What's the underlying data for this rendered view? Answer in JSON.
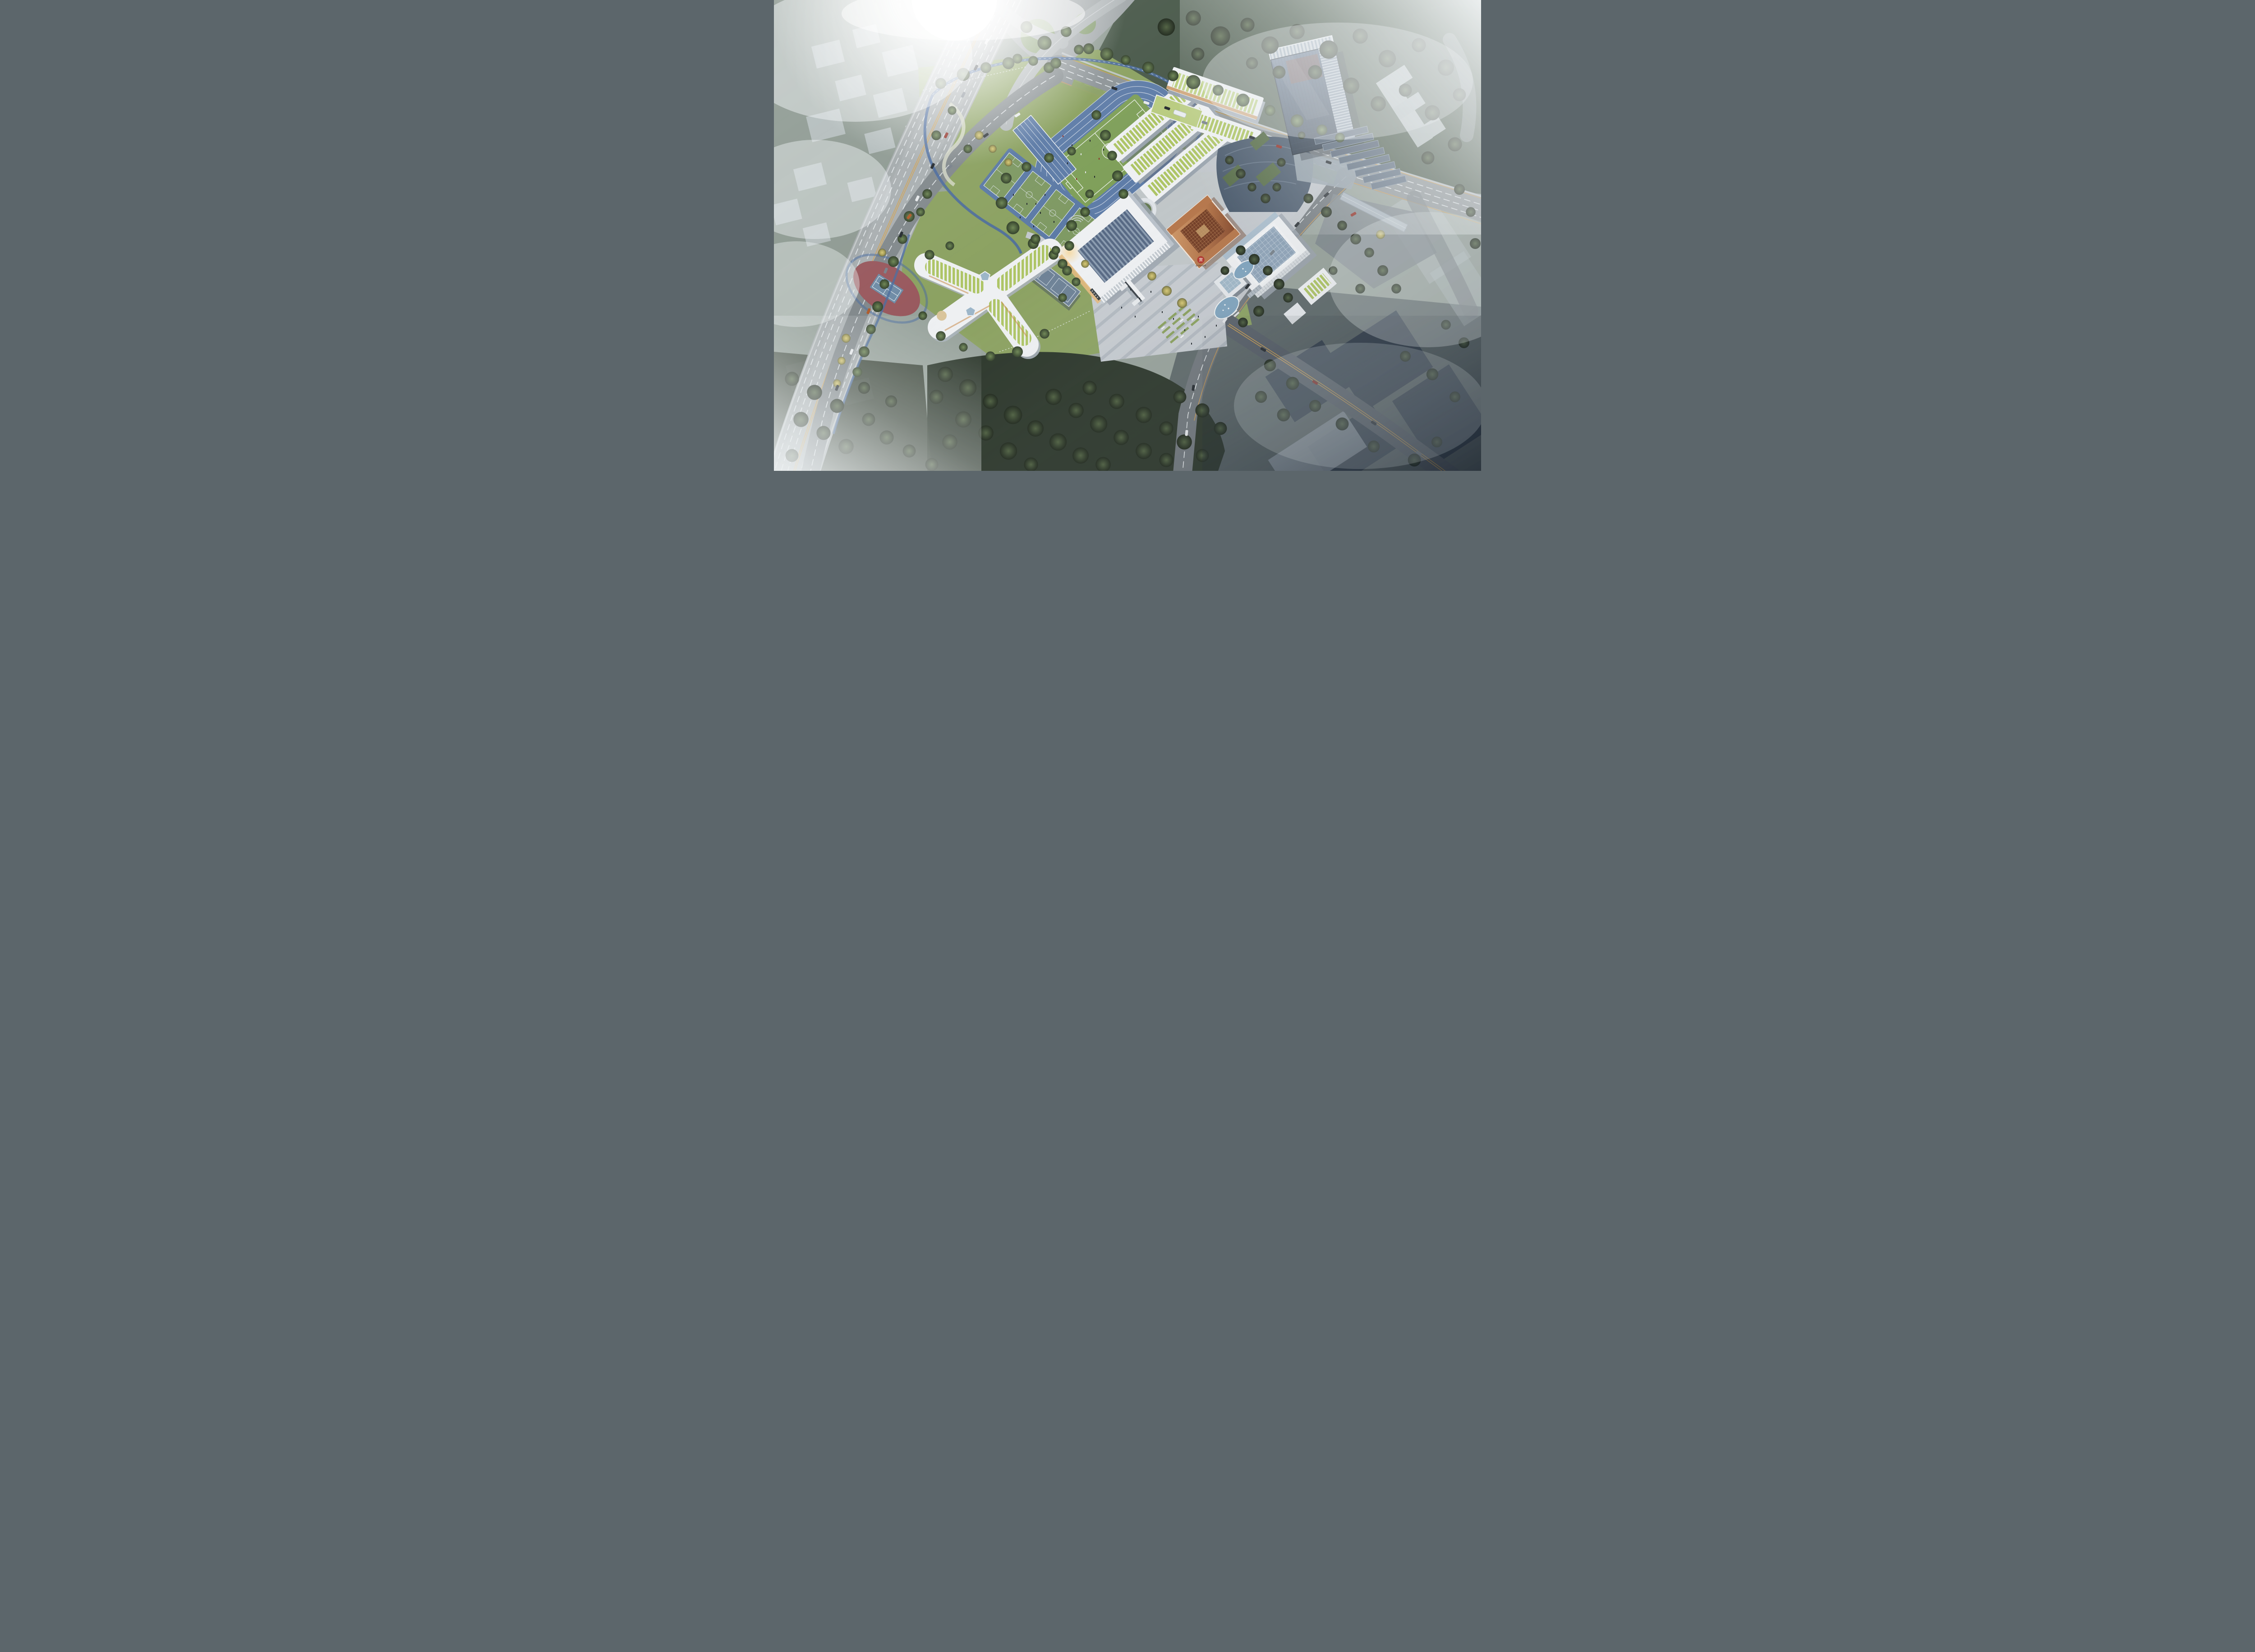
{
  "image": {
    "kind": "photorealistic aerial architectural rendering",
    "subject": "school campus masterplan at a foggy urban highway interchange",
    "lighting": "hazy morning sun flare from upper-left, dark mist toward lower-right"
  },
  "branding": {
    "seal_character": "實",
    "seal_text": "温州市实验中学",
    "seal_color": "#b0342c"
  },
  "zones": {
    "sports": {
      "running_track": "blue 6-lane oval running track with green soccer field",
      "long_jump": "blue sprint/long-jump strip beside track",
      "basketball": "row of 4 green basketball courts on blue pad",
      "badminton": "covered badminton canopy south of courts",
      "tennis": "single blue tennis court on red oval pad in linear park"
    },
    "buildings": {
      "classroom_wings": "three parallel white teaching slabs with green roof strips",
      "north_building": "white classroom bar with green louvered roof along north road",
      "auditorium": "white hall with sawtooth blue-grey skylight roof and colonnade",
      "library_cube": "copper-clad cube with carved lattice roof and red school seal",
      "gymnasium": "white box with large blue-grey glazed roof panel",
      "kindergarten": "white X-shaped building with green striped roofs and two pentagonal skylights",
      "tower": "dark glass high-rise with louvered core and stepped garden terraces",
      "entrance_gate": "white portal gate with dark sign band on south plaza",
      "pavilion": "small glass-roofed pavilion beside fountain ponds"
    },
    "landscape": {
      "sunken_courtyard": "circular glowing sunken courtyard",
      "plaza": "striped paving plaza with lawn modules, benches and ginkgo trees",
      "ponds": "two kidney-shaped fountain pools",
      "forest_south": "dense dark tree parcel south of campus",
      "linear_park": "jogging-loop park strip along elevated highway",
      "fog": "translucent white massing blocks of surrounding city fading into mist"
    },
    "roads": {
      "highway": "elevated multi-lane highway running diagonally on the left",
      "interchange": "curved ramp interchange at top-left under sun flare",
      "north_arterial": "walled arterial road across the top with bus and crosswalk",
      "east_road": "tree-lined road along east campus edge with crosswalks",
      "southeast_road": "dark road with double yellow line fading into fog",
      "sky_bridge": "pedestrian bridge from tower terraces across intersection"
    }
  },
  "counts": {
    "track_lanes": 6,
    "basketball_courts": 4,
    "soccer_goals": 2,
    "classroom_wings": 3,
    "pentagon_skylights": 2,
    "fountain_pools": 2
  },
  "colors": {
    "track_blue": "#5f7da8",
    "field_green": "#7fa05a",
    "court_green": "#7f9a64",
    "court_pad_blue": "#5d7ba6",
    "tennis_red": "#99595e",
    "tennis_blue": "#6f8ca6",
    "jog_path_blue": "#4c6d9e",
    "lawn": "#8ca262",
    "forest_dark": "#2c372b",
    "tree_yellow": "#c7ba66",
    "asphalt_light": "#a4aaac",
    "asphalt_mid": "#8e9598",
    "asphalt_dark": "#5a626b",
    "lane_yellow": "#d2a455",
    "building_white": "#eef0f2",
    "roof_green": "#aec566",
    "sawtooth_blue": "#5d7089",
    "copper_light": "#cf9a6a",
    "copper_dark": "#7d4228",
    "lattice_brown": "#713c24",
    "glass_blue": "#8ea3b7",
    "tower_glass": "#3e4f63",
    "podium_slate": "#4a5a6c",
    "pond_blue": "#7fa3bd",
    "plaza_grey": "#c6cbd0",
    "massing_light": "#d0d8dd",
    "massing_dark": "#2e3a49",
    "fog_white": "#f3f6f7",
    "warm_glow": "#e3b97e"
  }
}
